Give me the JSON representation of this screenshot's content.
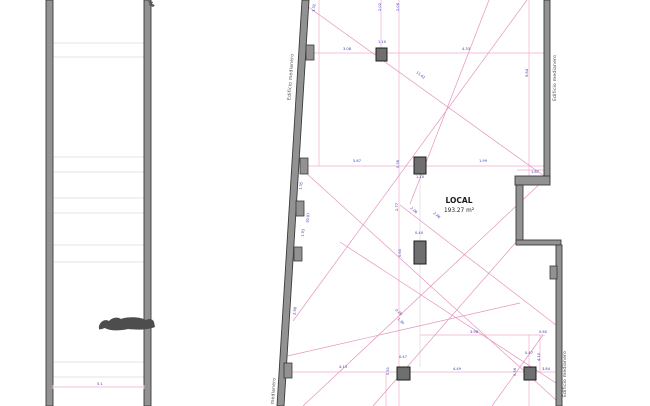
{
  "colors": {
    "background": "#ffffff",
    "wall_fill": "#929292",
    "wall_stroke": "#3a3a3a",
    "column_fill": "#6f6f6f",
    "column_stroke": "#1c1c1c",
    "dim_line_pink": "#f0aecf",
    "dim_line_pink_strong": "#e693bd",
    "construction_gray": "#d9d9d9",
    "tread_line": "#e3e3e3",
    "dim_text_blue": "#3a3ab8",
    "label_gray": "#4a4a4a",
    "figure_blob": "#4d4d4d"
  },
  "left_plan": {
    "walls": [
      {
        "x": 46,
        "y": 0,
        "w": 7,
        "h": 406
      },
      {
        "x": 144,
        "y": 0,
        "w": 7,
        "h": 406
      }
    ],
    "tread_x1": 53,
    "tread_x2": 144,
    "tread_lines_y": [
      43,
      57,
      157,
      172,
      198,
      213,
      245,
      262,
      362,
      377
    ],
    "figure_blob_path": "M99,329 c-1,-6 5,-11 10,-8 c4,-4 9,-4 12,-2 c8,-3 20,-2 25,1 c3,-2 7,-1 8,2 l1,5 c-7,3 -19,3 -27,2 c-8,2 -18,2 -23,-1 c-3,1 -6,2 -6,1 z",
    "dim_line": {
      "y": 387,
      "x1": 53,
      "x2": 144,
      "label": "5.1",
      "label_x": 97,
      "label_y": 385
    },
    "corner_mark_path": "M149,1 l4,1 l-1,2 l3,1 l-2,2 l-4,-2 l1,-2 l-2,-1 z"
  },
  "right_plan": {
    "area_label": {
      "title": "LOCAL",
      "area": "193.27 m²",
      "x": 459,
      "y": 203,
      "y2": 212
    },
    "boundary_labels": [
      {
        "text": "Edificio medianero",
        "x": 292,
        "y": 77,
        "rot": -86
      },
      {
        "text": "Edificio medianero",
        "x": 274,
        "y": 401,
        "rot": -86
      },
      {
        "text": "Edificio medianero",
        "x": 556,
        "y": 78,
        "rot": -90
      },
      {
        "text": "Edificio medianero",
        "x": 566,
        "y": 374,
        "rot": -90
      }
    ],
    "wall_polygons": [
      {
        "points": "302,0 309,0 284,406 277,406"
      }
    ],
    "wall_rects": [
      {
        "x": 544,
        "y": 0,
        "w": 6,
        "h": 178
      },
      {
        "x": 515,
        "y": 176,
        "w": 35,
        "h": 9
      },
      {
        "x": 516,
        "y": 185,
        "w": 7,
        "h": 58
      },
      {
        "x": 516,
        "y": 240,
        "w": 45,
        "h": 5
      },
      {
        "x": 556,
        "y": 245,
        "w": 6,
        "h": 161
      }
    ],
    "pilasters": [
      {
        "x": 306,
        "y": 45,
        "w": 8,
        "h": 15
      },
      {
        "x": 300,
        "y": 158,
        "w": 8,
        "h": 16
      },
      {
        "x": 296,
        "y": 201,
        "w": 8,
        "h": 15
      },
      {
        "x": 294,
        "y": 247,
        "w": 8,
        "h": 14
      },
      {
        "x": 284,
        "y": 363,
        "w": 8,
        "h": 15
      },
      {
        "x": 550,
        "y": 266,
        "w": 7,
        "h": 13
      }
    ],
    "columns": [
      {
        "x": 376,
        "y": 48,
        "w": 11,
        "h": 13
      },
      {
        "x": 414,
        "y": 157,
        "w": 12,
        "h": 17
      },
      {
        "x": 414,
        "y": 241,
        "w": 12,
        "h": 23
      },
      {
        "x": 397,
        "y": 367,
        "w": 13,
        "h": 13
      },
      {
        "x": 524,
        "y": 367,
        "w": 12,
        "h": 13
      }
    ],
    "dim_lines_horizontal": [
      {
        "x1": 309,
        "y1": 53,
        "x2": 544,
        "y2": 53
      },
      {
        "x1": 303,
        "y1": 166,
        "x2": 544,
        "y2": 166
      },
      {
        "x1": 517,
        "y1": 170,
        "x2": 549,
        "y2": 170
      },
      {
        "x1": 420,
        "y1": 335,
        "x2": 545,
        "y2": 335
      },
      {
        "x1": 285,
        "y1": 372,
        "x2": 556,
        "y2": 372
      }
    ],
    "dim_lines_vertical": [
      {
        "x1": 319,
        "y1": 0,
        "x2": 319,
        "y2": 166
      },
      {
        "x1": 381,
        "y1": 0,
        "x2": 381,
        "y2": 48
      },
      {
        "x1": 399,
        "y1": 0,
        "x2": 399,
        "y2": 406
      },
      {
        "x1": 529,
        "y1": 0,
        "x2": 529,
        "y2": 176
      },
      {
        "x1": 529,
        "y1": 335,
        "x2": 529,
        "y2": 406
      },
      {
        "x1": 540,
        "y1": 335,
        "x2": 540,
        "y2": 372
      },
      {
        "x1": 386,
        "y1": 372,
        "x2": 386,
        "y2": 406
      },
      {
        "x1": 420,
        "y1": 174,
        "x2": 420,
        "y2": 367,
        "gray": true
      }
    ],
    "dim_lines_diagonal": [
      {
        "x1": 307,
        "y1": 6,
        "x2": 544,
        "y2": 176
      },
      {
        "x1": 489,
        "y1": 0,
        "x2": 410,
        "y2": 204
      },
      {
        "x1": 527,
        "y1": 0,
        "x2": 293,
        "y2": 321
      },
      {
        "x1": 305,
        "y1": 172,
        "x2": 556,
        "y2": 400
      },
      {
        "x1": 544,
        "y1": 180,
        "x2": 303,
        "y2": 406
      },
      {
        "x1": 517,
        "y1": 241,
        "x2": 373,
        "y2": 406
      },
      {
        "x1": 283,
        "y1": 357,
        "x2": 520,
        "y2": 303
      },
      {
        "x1": 400,
        "y1": 205,
        "x2": 556,
        "y2": 325
      },
      {
        "x1": 340,
        "y1": 242,
        "x2": 556,
        "y2": 383
      },
      {
        "x1": 543,
        "y1": 335,
        "x2": 492,
        "y2": 406
      }
    ],
    "dimensions": [
      {
        "text": "3.32",
        "x": 315,
        "y": 8,
        "rot": -83
      },
      {
        "text": "2.02",
        "x": 381,
        "y": 7,
        "rot": -90
      },
      {
        "text": "2.06",
        "x": 399,
        "y": 7,
        "rot": -90
      },
      {
        "text": "3.08",
        "x": 347,
        "y": 50,
        "rot": 0
      },
      {
        "text": "1.10",
        "x": 382,
        "y": 43,
        "rot": 0
      },
      {
        "text": "4.33",
        "x": 466,
        "y": 50,
        "rot": 0
      },
      {
        "text": "5.64",
        "x": 528,
        "y": 73,
        "rot": -90
      },
      {
        "text": "11.61",
        "x": 420,
        "y": 76,
        "rot": 37
      },
      {
        "text": "1.35",
        "x": 302,
        "y": 186,
        "rot": -83
      },
      {
        "text": "10.07",
        "x": 309,
        "y": 218,
        "rot": -83
      },
      {
        "text": "1.93",
        "x": 304,
        "y": 233,
        "rot": -83
      },
      {
        "text": "5.67",
        "x": 357,
        "y": 162,
        "rot": 0
      },
      {
        "text": "0.36",
        "x": 399,
        "y": 164,
        "rot": -90
      },
      {
        "text": "1.99",
        "x": 483,
        "y": 162,
        "rot": 0
      },
      {
        "text": "1.87",
        "x": 535,
        "y": 173,
        "rot": 0
      },
      {
        "text": "1.10",
        "x": 420,
        "y": 178,
        "rot": 0
      },
      {
        "text": "2.77",
        "x": 398,
        "y": 207,
        "rot": -90
      },
      {
        "text": "2.06",
        "x": 413,
        "y": 211,
        "rot": 42
      },
      {
        "text": "2.46",
        "x": 436,
        "y": 216,
        "rot": 42
      },
      {
        "text": "0.40",
        "x": 419,
        "y": 234,
        "rot": 0
      },
      {
        "text": "0.60",
        "x": 401,
        "y": 253,
        "rot": -90
      },
      {
        "text": "2.98",
        "x": 296,
        "y": 311,
        "rot": -83
      },
      {
        "text": "0.28",
        "x": 398,
        "y": 313,
        "rot": 42
      },
      {
        "text": "1.30",
        "x": 400,
        "y": 322,
        "rot": 42
      },
      {
        "text": "3.98",
        "x": 474,
        "y": 333,
        "rot": 0
      },
      {
        "text": "0.60",
        "x": 543,
        "y": 333,
        "rot": 0
      },
      {
        "text": "4.13",
        "x": 343,
        "y": 368,
        "rot": 0
      },
      {
        "text": "0.47",
        "x": 403,
        "y": 358,
        "rot": 0
      },
      {
        "text": "0.51",
        "x": 389,
        "y": 371,
        "rot": -90
      },
      {
        "text": "4.49",
        "x": 457,
        "y": 370,
        "rot": 0
      },
      {
        "text": "0.47",
        "x": 529,
        "y": 354,
        "rot": 0
      },
      {
        "text": "4.10",
        "x": 540,
        "y": 357,
        "rot": -90
      },
      {
        "text": "0.36",
        "x": 516,
        "y": 372,
        "rot": -90
      },
      {
        "text": "3.84",
        "x": 546,
        "y": 370,
        "rot": 0
      }
    ]
  }
}
